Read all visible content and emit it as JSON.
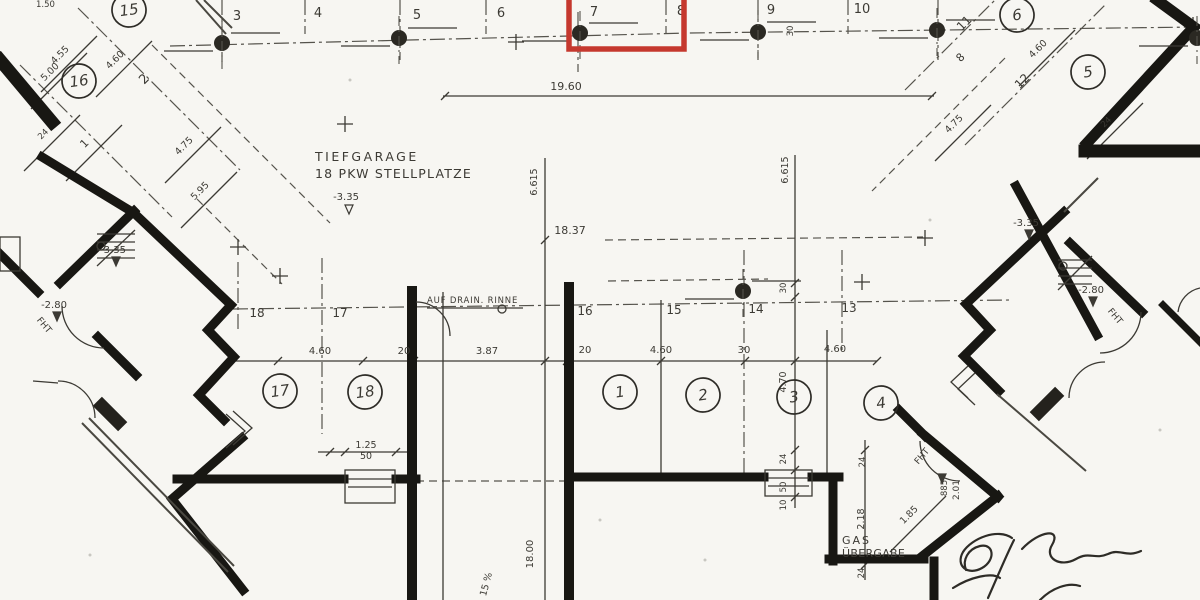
{
  "title": {
    "line1": "TIEFGARAGE",
    "line2": "18 PKW STELLPLATZE"
  },
  "colors": {
    "paper": "#f7f6f2",
    "ink": "#3c3a34",
    "wall": "#181713",
    "highlight_red": "#c5382e"
  },
  "highlight_box": {
    "x": 569,
    "y": -10,
    "width": 115,
    "height": 59,
    "stroke_width": 5.5
  },
  "plan_labels": [
    {
      "t": "TIEFGARAGE",
      "x": 315,
      "y": 161,
      "s": 12.5,
      "sp": 2.5,
      "a": "s"
    },
    {
      "t": "18 PKW STELLPLATZE",
      "x": 315,
      "y": 178,
      "s": 12.5,
      "sp": 1.2,
      "a": "s"
    },
    {
      "t": "AUF DRAIN. RINNE",
      "x": 427,
      "y": 303,
      "s": 8.5,
      "sp": 0.8,
      "a": "s"
    },
    {
      "t": "GAS",
      "x": 842,
      "y": 544,
      "s": 11,
      "sp": 2,
      "a": "s"
    },
    {
      "t": "ÜBERGABE",
      "x": 842,
      "y": 557,
      "s": 11,
      "sp": 0.3,
      "a": "s"
    },
    {
      "t": "1.50",
      "x": 36,
      "y": 7,
      "s": 8.5,
      "a": "s"
    },
    {
      "t": "3",
      "x": 237,
      "y": 20,
      "s": 13
    },
    {
      "t": "4",
      "x": 318,
      "y": 17,
      "s": 13
    },
    {
      "t": "5",
      "x": 417,
      "y": 19,
      "s": 13
    },
    {
      "t": "6",
      "x": 501,
      "y": 17,
      "s": 13
    },
    {
      "t": "7",
      "x": 594,
      "y": 16,
      "s": 13
    },
    {
      "t": "8",
      "x": 681,
      "y": 15,
      "s": 13
    },
    {
      "t": "9",
      "x": 771,
      "y": 14,
      "s": 13
    },
    {
      "t": "10",
      "x": 862,
      "y": 13,
      "s": 13
    },
    {
      "t": "18",
      "x": 257,
      "y": 317,
      "s": 12
    },
    {
      "t": "17",
      "x": 340,
      "y": 317,
      "s": 12
    },
    {
      "t": "16",
      "x": 585,
      "y": 315,
      "s": 12
    },
    {
      "t": "15",
      "x": 674,
      "y": 314,
      "s": 12
    },
    {
      "t": "14",
      "x": 756,
      "y": 313,
      "s": 12
    },
    {
      "t": "13",
      "x": 849,
      "y": 312,
      "s": 12
    },
    {
      "t": "2",
      "x": 147,
      "y": 82,
      "s": 13,
      "r": -45
    },
    {
      "t": "1",
      "x": 87,
      "y": 146,
      "s": 11,
      "r": -45
    },
    {
      "t": "11",
      "x": 967,
      "y": 26,
      "s": 12,
      "r": -45
    },
    {
      "t": "12",
      "x": 1025,
      "y": 84,
      "s": 12,
      "r": -45
    },
    {
      "t": "8",
      "x": 963,
      "y": 60,
      "s": 11,
      "r": -45
    },
    {
      "t": "4.55",
      "x": 62,
      "y": 57,
      "s": 9.5,
      "r": -45
    },
    {
      "t": "5.00",
      "x": 52,
      "y": 74,
      "s": 9.5,
      "r": -45
    },
    {
      "t": "4.60",
      "x": 117,
      "y": 62,
      "s": 9.5,
      "r": -45
    },
    {
      "t": "24",
      "x": 45,
      "y": 136,
      "s": 8.5,
      "r": -45
    },
    {
      "t": "4.75",
      "x": 186,
      "y": 148,
      "s": 9.5,
      "r": -45
    },
    {
      "t": "5.95",
      "x": 202,
      "y": 193,
      "s": 9.5,
      "r": -45
    },
    {
      "t": "4.75",
      "x": 956,
      "y": 126,
      "s": 9.5,
      "r": -45
    },
    {
      "t": "4.60",
      "x": 1040,
      "y": 51,
      "s": 9.5,
      "r": -45
    },
    {
      "t": "24",
      "x": 1108,
      "y": 124,
      "s": 8.5,
      "r": -45
    },
    {
      "t": "1.85",
      "x": 911,
      "y": 517,
      "s": 9.5,
      "r": -45
    },
    {
      "t": "19.60",
      "x": 566,
      "y": 90,
      "s": 11
    },
    {
      "t": "18.37",
      "x": 570,
      "y": 234,
      "s": 11
    },
    {
      "t": "4.60",
      "x": 320,
      "y": 354,
      "s": 10
    },
    {
      "t": "20",
      "x": 404,
      "y": 354,
      "s": 10
    },
    {
      "t": "3.87",
      "x": 487,
      "y": 354,
      "s": 10
    },
    {
      "t": "20",
      "x": 585,
      "y": 353,
      "s": 10
    },
    {
      "t": "4.60",
      "x": 661,
      "y": 353,
      "s": 10
    },
    {
      "t": "30",
      "x": 744,
      "y": 353,
      "s": 10
    },
    {
      "t": "4.60",
      "x": 835,
      "y": 352,
      "s": 10
    },
    {
      "t": "1.25",
      "x": 366,
      "y": 448,
      "s": 9.5
    },
    {
      "t": "50",
      "x": 366,
      "y": 459,
      "s": 9.5
    },
    {
      "t": "6.615",
      "x": 537,
      "y": 182,
      "s": 9.5,
      "r": -90
    },
    {
      "t": "6.615",
      "x": 788,
      "y": 170,
      "s": 9.5,
      "r": -90
    },
    {
      "t": "30",
      "x": 786,
      "y": 288,
      "s": 8.5,
      "r": -90
    },
    {
      "t": "30",
      "x": 793,
      "y": 31,
      "s": 8.5,
      "r": -90
    },
    {
      "t": "4.70",
      "x": 786,
      "y": 382,
      "s": 9.5,
      "r": -90
    },
    {
      "t": "24",
      "x": 786,
      "y": 459,
      "s": 8.5,
      "r": -90
    },
    {
      "t": "50",
      "x": 786,
      "y": 487,
      "s": 8.5,
      "r": -90
    },
    {
      "t": "10",
      "x": 786,
      "y": 505,
      "s": 8.5,
      "r": -90
    },
    {
      "t": "2.18",
      "x": 864,
      "y": 519,
      "s": 9.5,
      "r": -90
    },
    {
      "t": "24",
      "x": 865,
      "y": 462,
      "s": 8.5,
      "r": -90
    },
    {
      "t": "24",
      "x": 864,
      "y": 573,
      "s": 8.5,
      "r": -90
    },
    {
      "t": "18.00",
      "x": 533,
      "y": 554,
      "s": 10,
      "r": -90
    },
    {
      "t": "885",
      "x": 947,
      "y": 488,
      "s": 8.5,
      "r": -90
    },
    {
      "t": "2.01",
      "x": 959,
      "y": 490,
      "s": 9,
      "r": -90
    },
    {
      "t": "15 %",
      "x": 489,
      "y": 585,
      "s": 9.5,
      "r": -75
    },
    {
      "t": "-3.35",
      "x": 113,
      "y": 253,
      "s": 10
    },
    {
      "t": "-2.80",
      "x": 54,
      "y": 308,
      "s": 10
    },
    {
      "t": "-3.35",
      "x": 346,
      "y": 200,
      "s": 10
    },
    {
      "t": "-3.35",
      "x": 1026,
      "y": 226,
      "s": 10
    },
    {
      "t": "-2.80",
      "x": 1091,
      "y": 293,
      "s": 10
    },
    {
      "t": "FHT",
      "x": 42,
      "y": 327,
      "s": 9,
      "r": 50
    },
    {
      "t": "FHT",
      "x": 1113,
      "y": 318,
      "s": 9,
      "r": 50
    },
    {
      "t": "FHT",
      "x": 924,
      "y": 458,
      "s": 9,
      "r": -50
    }
  ],
  "level_markers": [
    {
      "x": 112,
      "y": 257,
      "filled": true
    },
    {
      "x": 53,
      "y": 312,
      "filled": true
    },
    {
      "x": 345,
      "y": 205,
      "filled": false
    },
    {
      "x": 1025,
      "y": 230,
      "filled": true
    },
    {
      "x": 1089,
      "y": 297,
      "filled": true
    },
    {
      "x": 938,
      "y": 474,
      "filled": true
    }
  ],
  "circled_numbers": [
    {
      "t": "15",
      "x": 129,
      "y": 10
    },
    {
      "t": "16",
      "x": 79,
      "y": 81
    },
    {
      "t": "6",
      "x": 1017,
      "y": 15
    },
    {
      "t": "5",
      "x": 1088,
      "y": 72
    },
    {
      "t": "17",
      "x": 280,
      "y": 391
    },
    {
      "t": "18",
      "x": 365,
      "y": 392
    },
    {
      "t": "1",
      "x": 620,
      "y": 392
    },
    {
      "t": "2",
      "x": 703,
      "y": 395
    },
    {
      "t": "3",
      "x": 794,
      "y": 397
    },
    {
      "t": "4",
      "x": 881,
      "y": 403
    }
  ],
  "columns": [
    {
      "x": 222,
      "y": 43
    },
    {
      "x": 399,
      "y": 38
    },
    {
      "x": 580,
      "y": 33
    },
    {
      "x": 758,
      "y": 32
    },
    {
      "x": 937,
      "y": 30
    },
    {
      "x": 1197,
      "y": 38
    },
    {
      "x": 743,
      "y": 291
    }
  ]
}
